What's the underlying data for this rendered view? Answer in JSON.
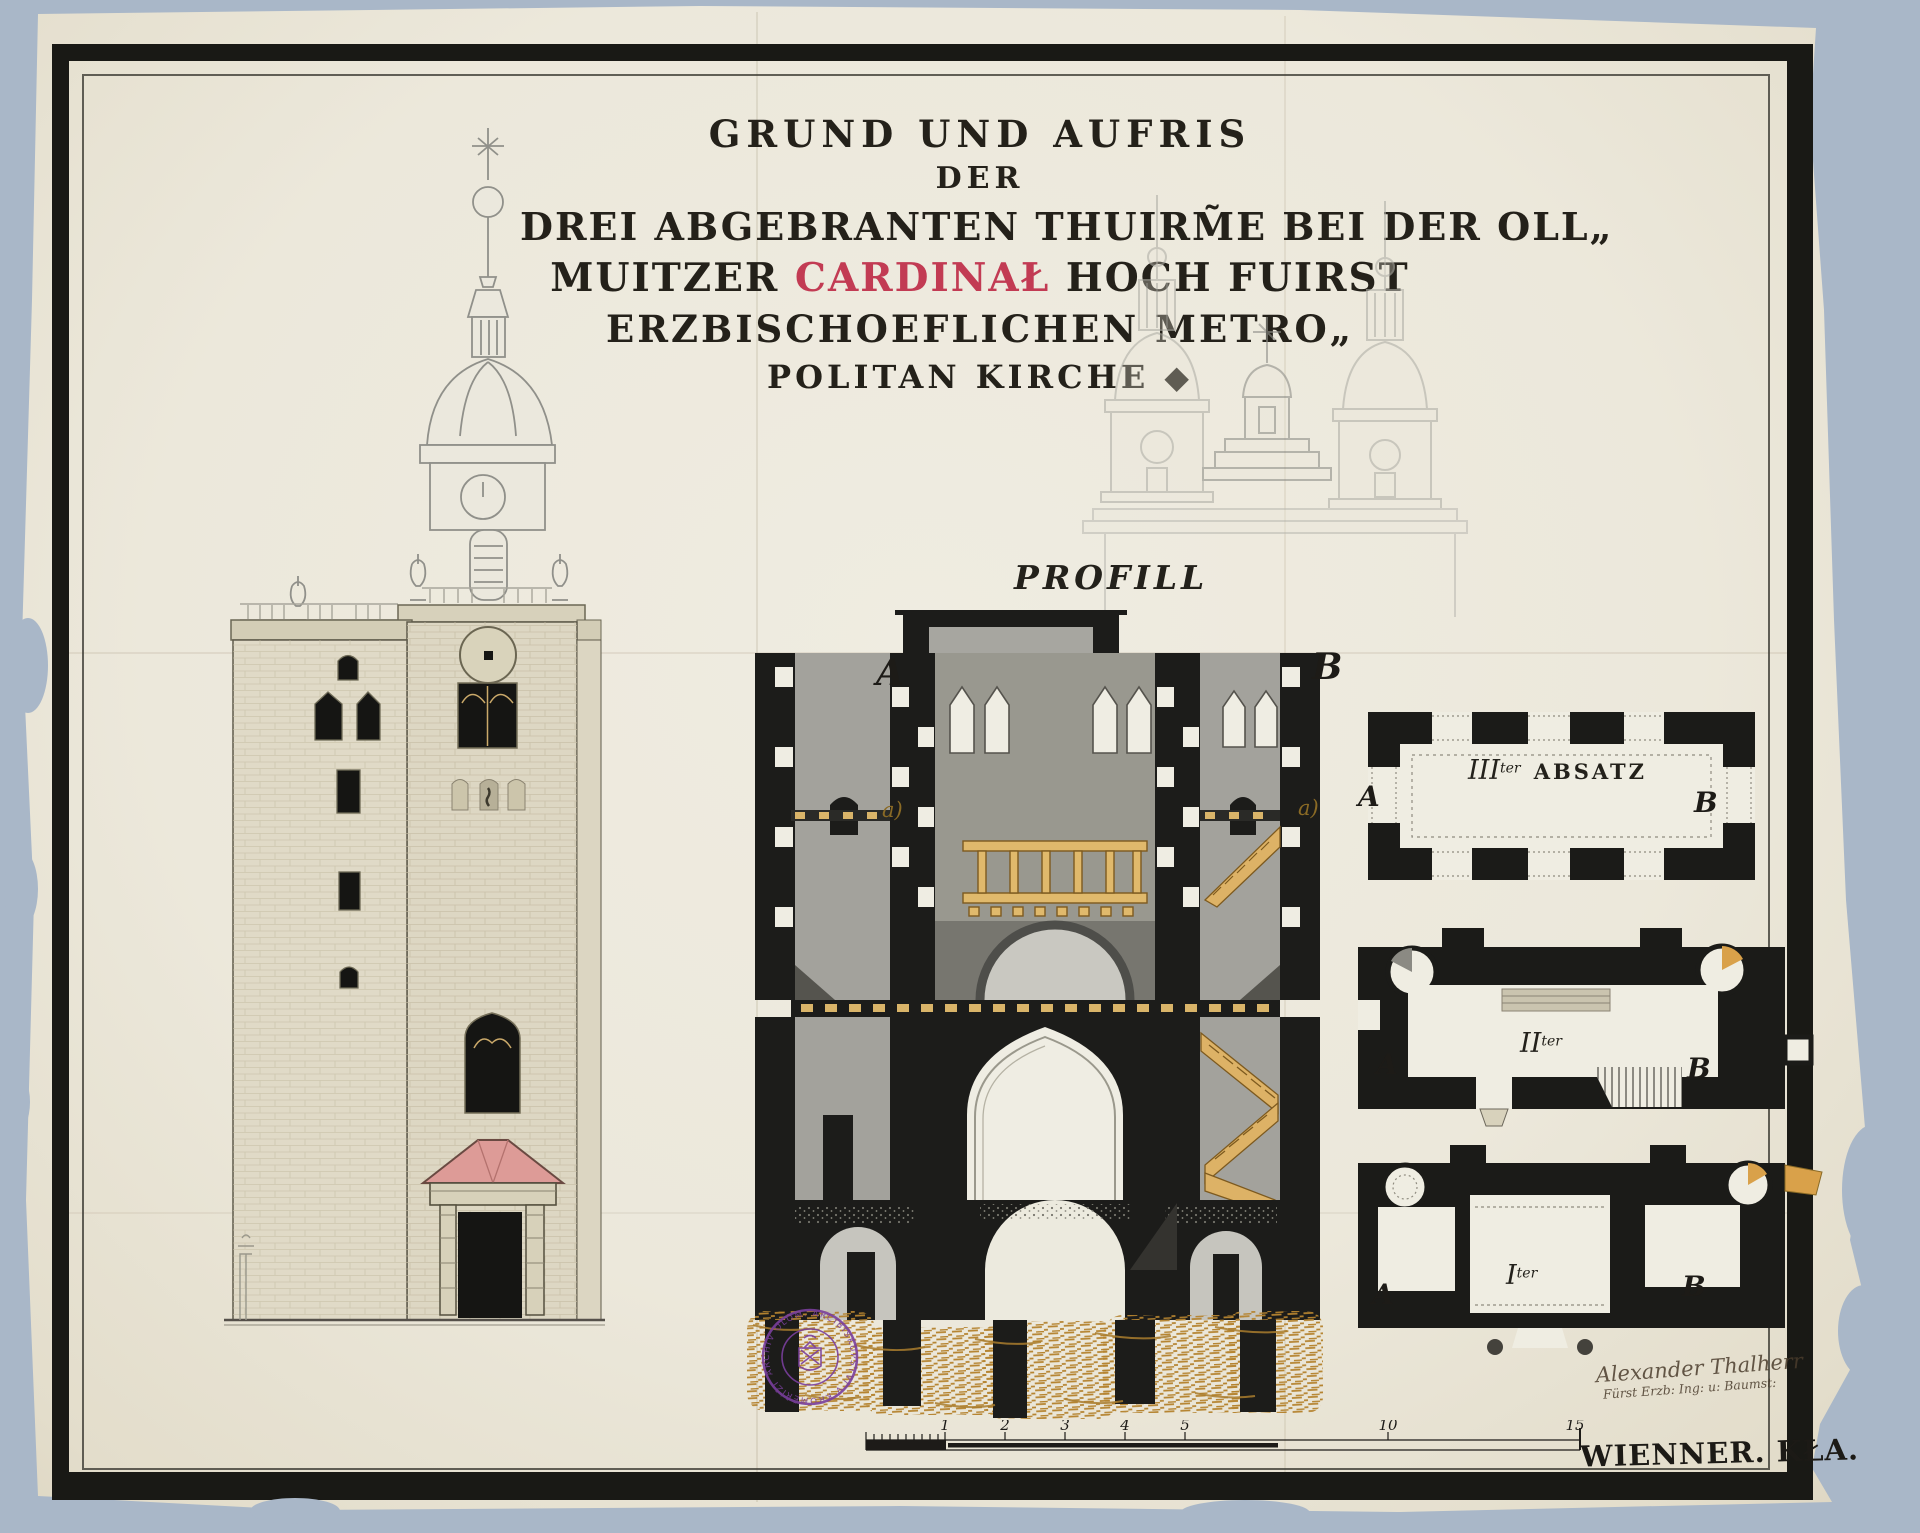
{
  "colors": {
    "background": "#a9b7c8",
    "paper": "#ece8db",
    "frame": "#191915",
    "ink": "#24211a",
    "red_accent": "#c23b53",
    "stamp_purple": "#7a3f9d",
    "timber_tan": "#d9b469",
    "earth_brown": "#b5832f",
    "portal_pink": "#dd9b97"
  },
  "title": {
    "line1": "GRUND UND AUFRIS",
    "line2": "DER",
    "line3": "DREI ABGEBRANTEN THUIRM̃E BEI DER OLL„",
    "line4_pre": "MUITZER ",
    "line4_red": "CARDINAŁ",
    "line4_post": " HOCH FUIRST",
    "line5": "ERZBISCHOEFLICHEN METRO„",
    "line6": "POLITAN KIRCHE ◆"
  },
  "profile": {
    "label": "PROFILL",
    "marker_a": "A",
    "marker_b": "B",
    "small_mark_left": "a)",
    "small_mark_right": "a)"
  },
  "plans": {
    "third": {
      "roman": "III",
      "sup": "ter",
      "name": "ABSATZ",
      "a": "A",
      "b": "B"
    },
    "second": {
      "roman": "II",
      "sup": "ter",
      "a": "A",
      "b": "B"
    },
    "first": {
      "roman": "I",
      "sup": "ter",
      "a": "A",
      "b": "B"
    }
  },
  "scale": {
    "ticks": [
      "1",
      "2",
      "3",
      "4",
      "5",
      "10",
      "15"
    ],
    "caption": "WIENNER. KŁA."
  },
  "stamp": {
    "text": "ARCHIV OLOM. ARCIBISKUPSTVÍ V KROMĚŘÍŽI ✦"
  },
  "signature": {
    "line1": "Alexander Thalherr",
    "line2": "Fürst Erzb: Ing: u: Baumst:"
  }
}
